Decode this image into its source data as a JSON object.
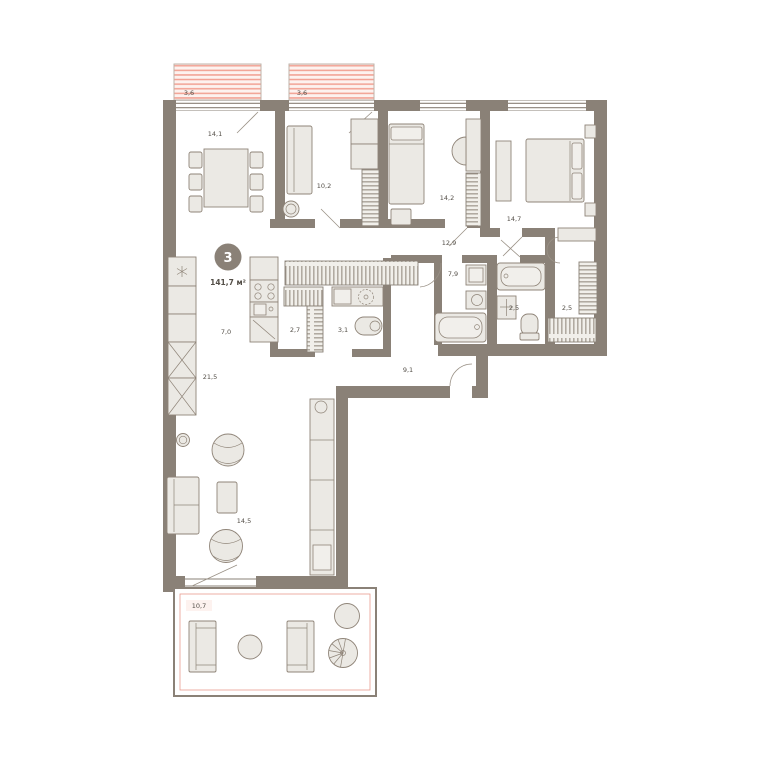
{
  "plan": {
    "badge": {
      "rooms_count": "3",
      "total_area": "141,7 м²"
    },
    "rooms": [
      {
        "name": "dining-room",
        "area": "14,1"
      },
      {
        "name": "bedroom-small",
        "area": "10,2"
      },
      {
        "name": "bedroom-middle",
        "area": "14,2"
      },
      {
        "name": "bedroom-master",
        "area": "14,7"
      },
      {
        "name": "hallway",
        "area": "12,9"
      },
      {
        "name": "bathroom-main",
        "area": "7,9"
      },
      {
        "name": "bathroom-guest",
        "area": "2,5"
      },
      {
        "name": "wardrobe-room",
        "area": "2,5"
      },
      {
        "name": "closet",
        "area": "2,7"
      },
      {
        "name": "laundry",
        "area": "3,1"
      },
      {
        "name": "kitchen",
        "area": "7,0"
      },
      {
        "name": "living-area",
        "area": "21,5"
      },
      {
        "name": "entry-hall",
        "area": "9,1"
      },
      {
        "name": "lounge-area",
        "area": "14,5"
      },
      {
        "name": "terrace",
        "area": "10,7"
      },
      {
        "name": "balcony-left",
        "area": "3,6"
      },
      {
        "name": "balcony-right",
        "area": "3,6"
      }
    ],
    "colors": {
      "wall": "#8a8177",
      "accent": "#f0978a",
      "balcony_fill": "#fdf2ef",
      "furniture_fill": "#ebe9e4",
      "label": "#544f48"
    }
  }
}
